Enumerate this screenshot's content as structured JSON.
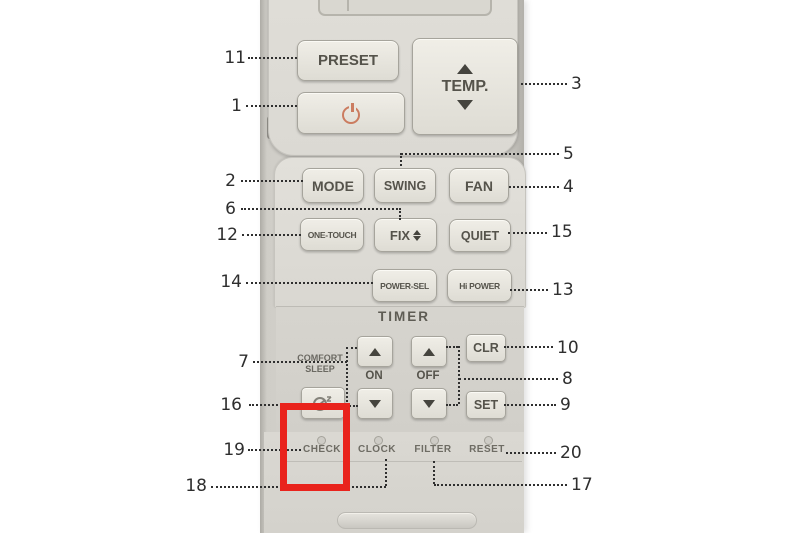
{
  "remote": {
    "top_panel": {
      "preset": "PRESET",
      "temp": "TEMP."
    },
    "mid_panel": {
      "mode": "MODE",
      "swing": "SWING",
      "fan": "FAN",
      "one_touch": "ONE-TOUCH",
      "fix": "FIX",
      "quiet": "QUIET",
      "power_sel": "POWER-SEL",
      "hi_power": "Hi POWER"
    },
    "timer_panel": {
      "heading": "TIMER",
      "on_label": "ON",
      "off_label": "OFF",
      "clr": "CLR",
      "set": "SET",
      "comfort_line1": "COMFORT",
      "comfort_line2": "SLEEP"
    },
    "bottom_panel": {
      "check": "CHECK",
      "clock": "CLOCK",
      "filter": "FILTER",
      "reset": "RESET"
    }
  },
  "callouts": {
    "c1": "1",
    "c2": "2",
    "c3": "3",
    "c4": "4",
    "c5": "5",
    "c6": "6",
    "c7": "7",
    "c8": "8",
    "c9": "9",
    "c10": "10",
    "c11": "11",
    "c12": "12",
    "c13": "13",
    "c14": "14",
    "c15": "15",
    "c16": "16",
    "c17": "17",
    "c18": "18",
    "c19": "19",
    "c20": "20"
  },
  "colors": {
    "highlight_red": "#e9231c",
    "power_icon": "#cb7c60",
    "body_grey": "#d8d6d0"
  }
}
